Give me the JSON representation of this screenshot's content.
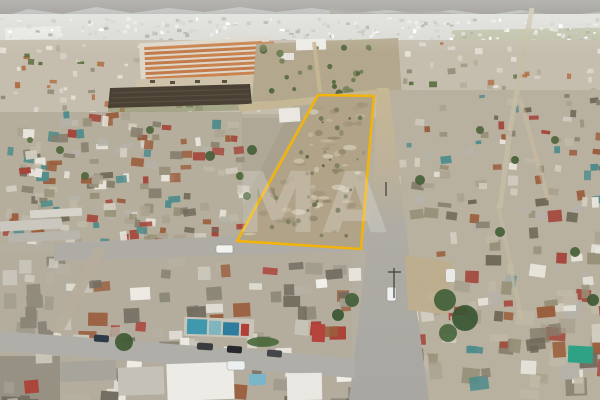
{
  "scene": {
    "description": "Aerial drone photograph of a dense town; a large vacant land parcel is outlined in yellow between streets, hazy mountains and distant city on the horizon",
    "watermark": "MA",
    "parcel_outline_color": "#f2b40a"
  }
}
